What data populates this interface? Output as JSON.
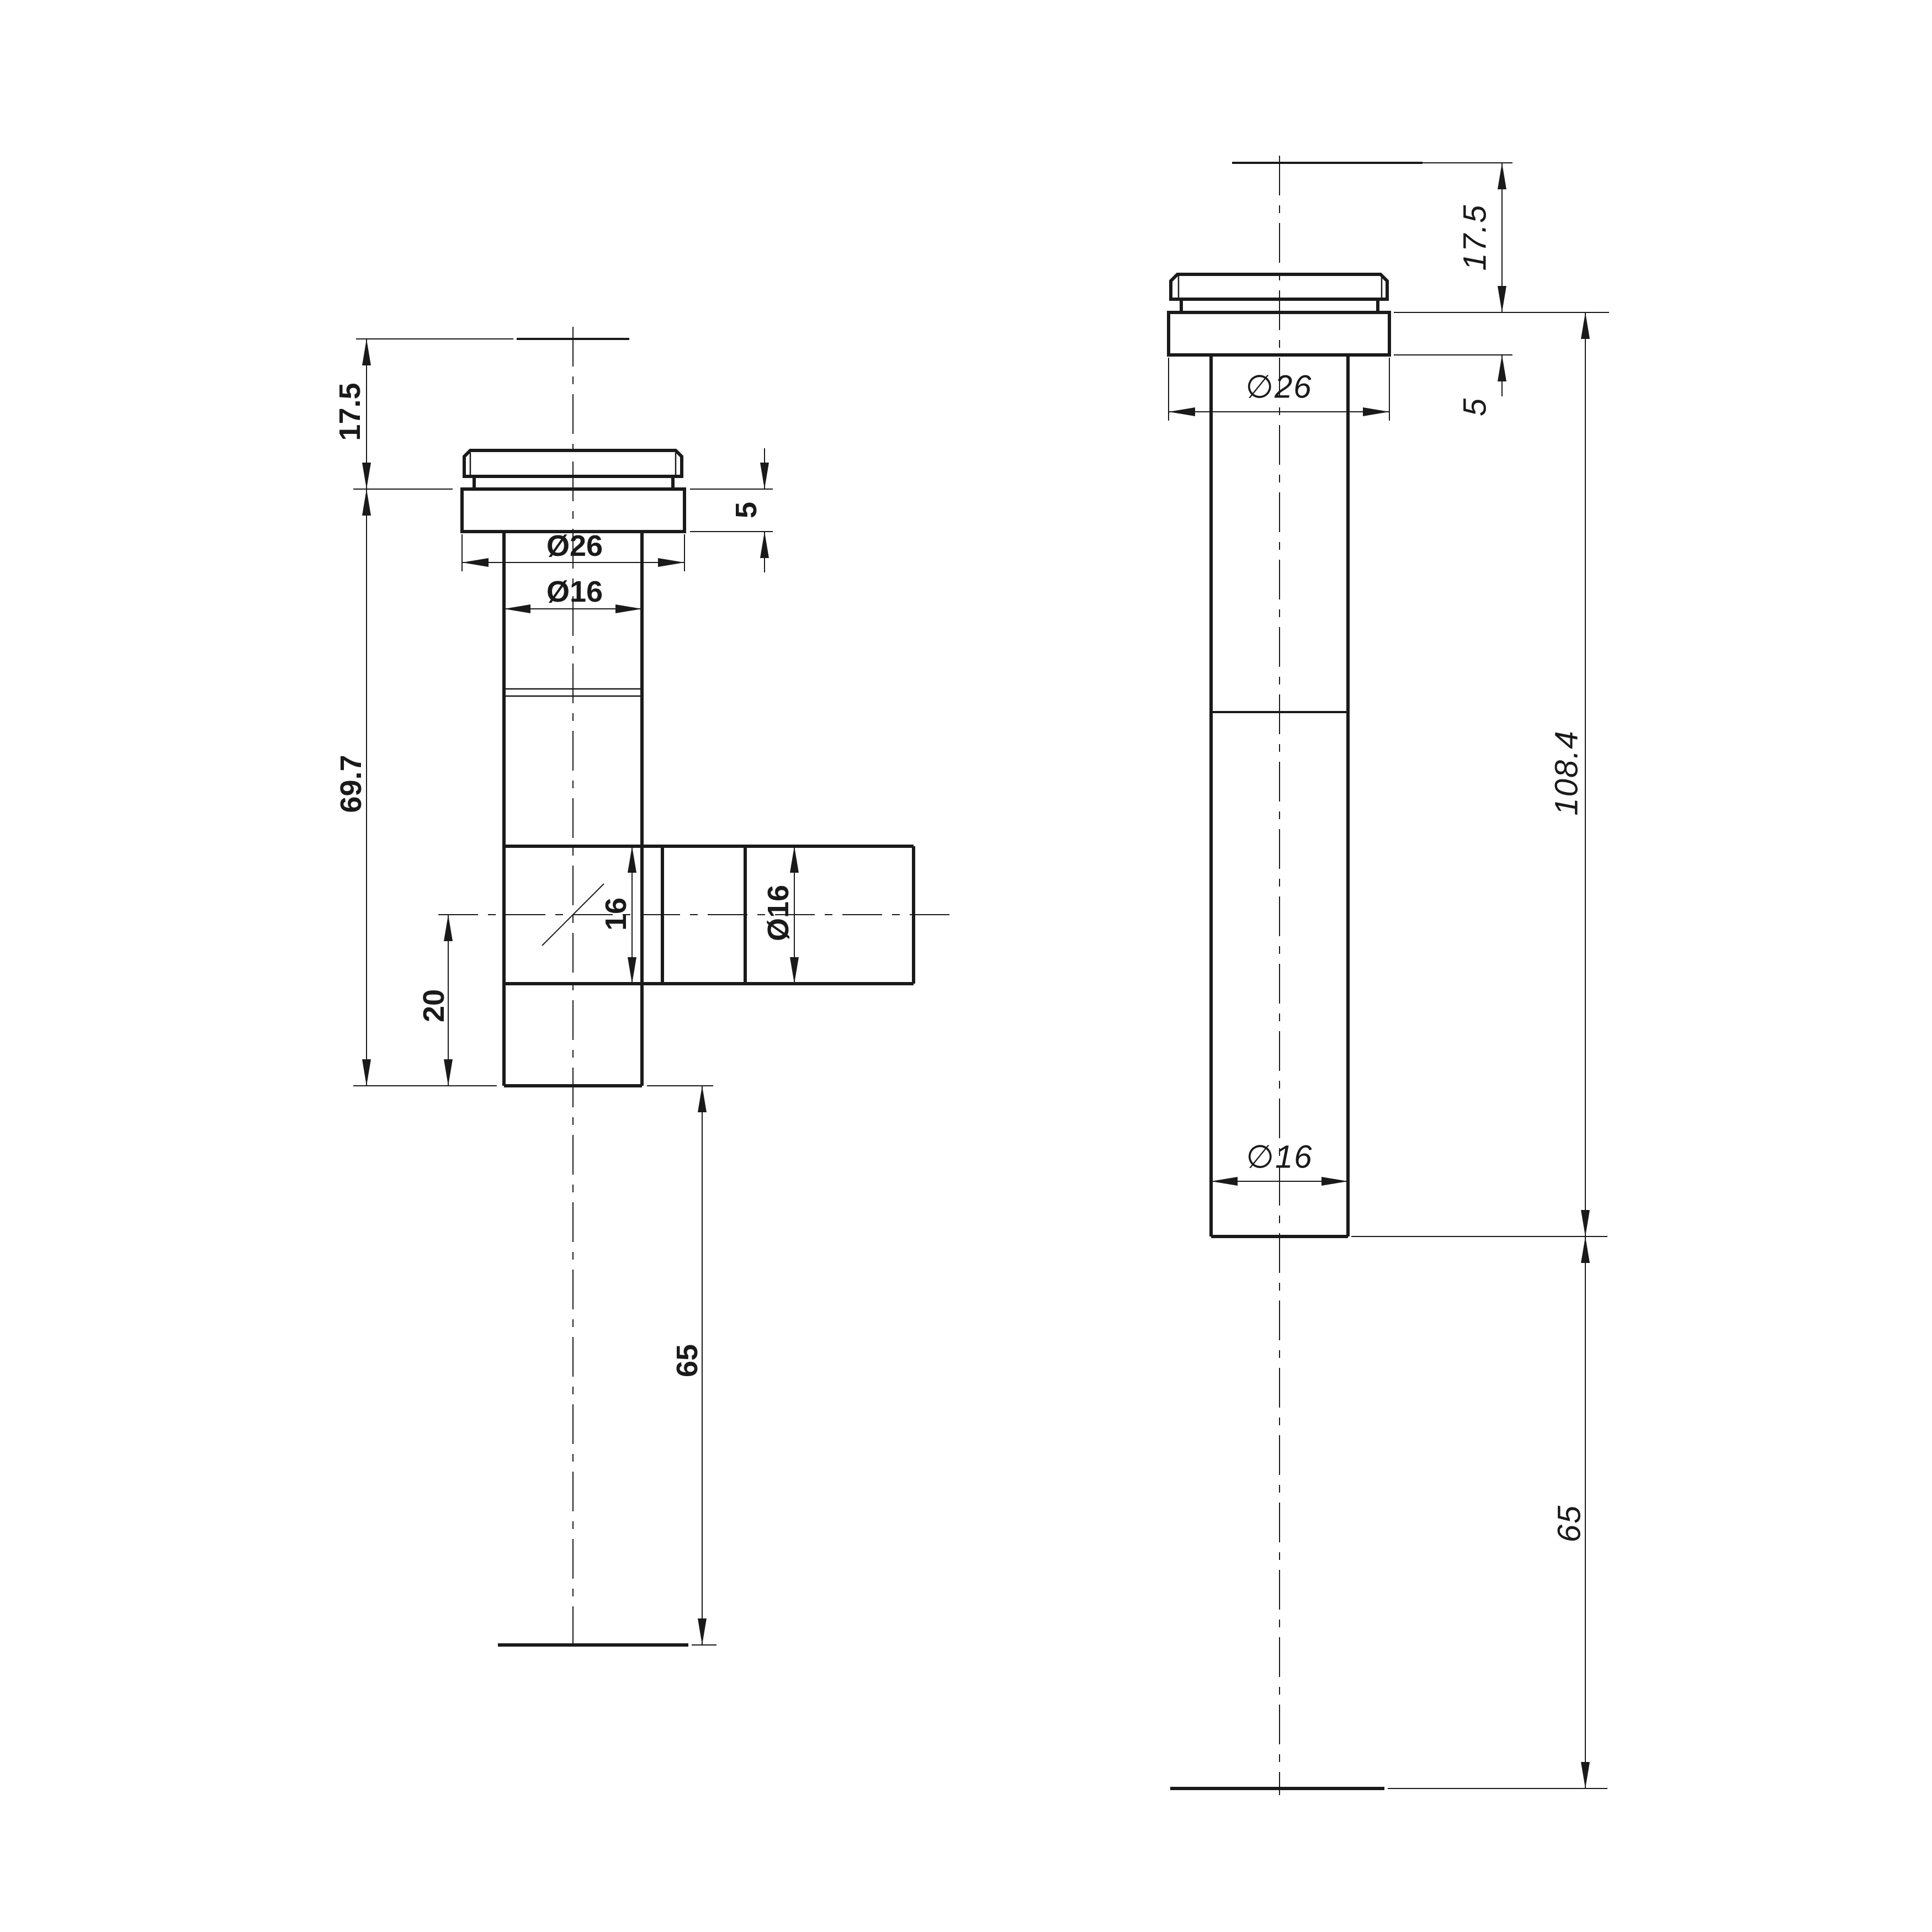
{
  "page": {
    "background": "#ffffff",
    "line_color": "#1a1a1a",
    "description": "technical drawing, two views of tube fitting with dimensions"
  },
  "views": {
    "front": {
      "label": "front-tee-view",
      "dims": {
        "top_offset": "17.5",
        "body_height": "69.7",
        "branch_center_offset": "20",
        "branch_bore": "16",
        "flange_dia": "Ø26",
        "shaft_dia": "Ø16",
        "branch_dia": "Ø16",
        "flange_thickness": "5",
        "bottom_offset": "65"
      }
    },
    "side": {
      "label": "side-straight-view",
      "dims": {
        "top_offset": "17.5",
        "flange_thickness": "5",
        "flange_dia": "∅26",
        "body_height": "108.4",
        "shaft_dia": "∅16",
        "bottom_offset": "65"
      }
    }
  }
}
